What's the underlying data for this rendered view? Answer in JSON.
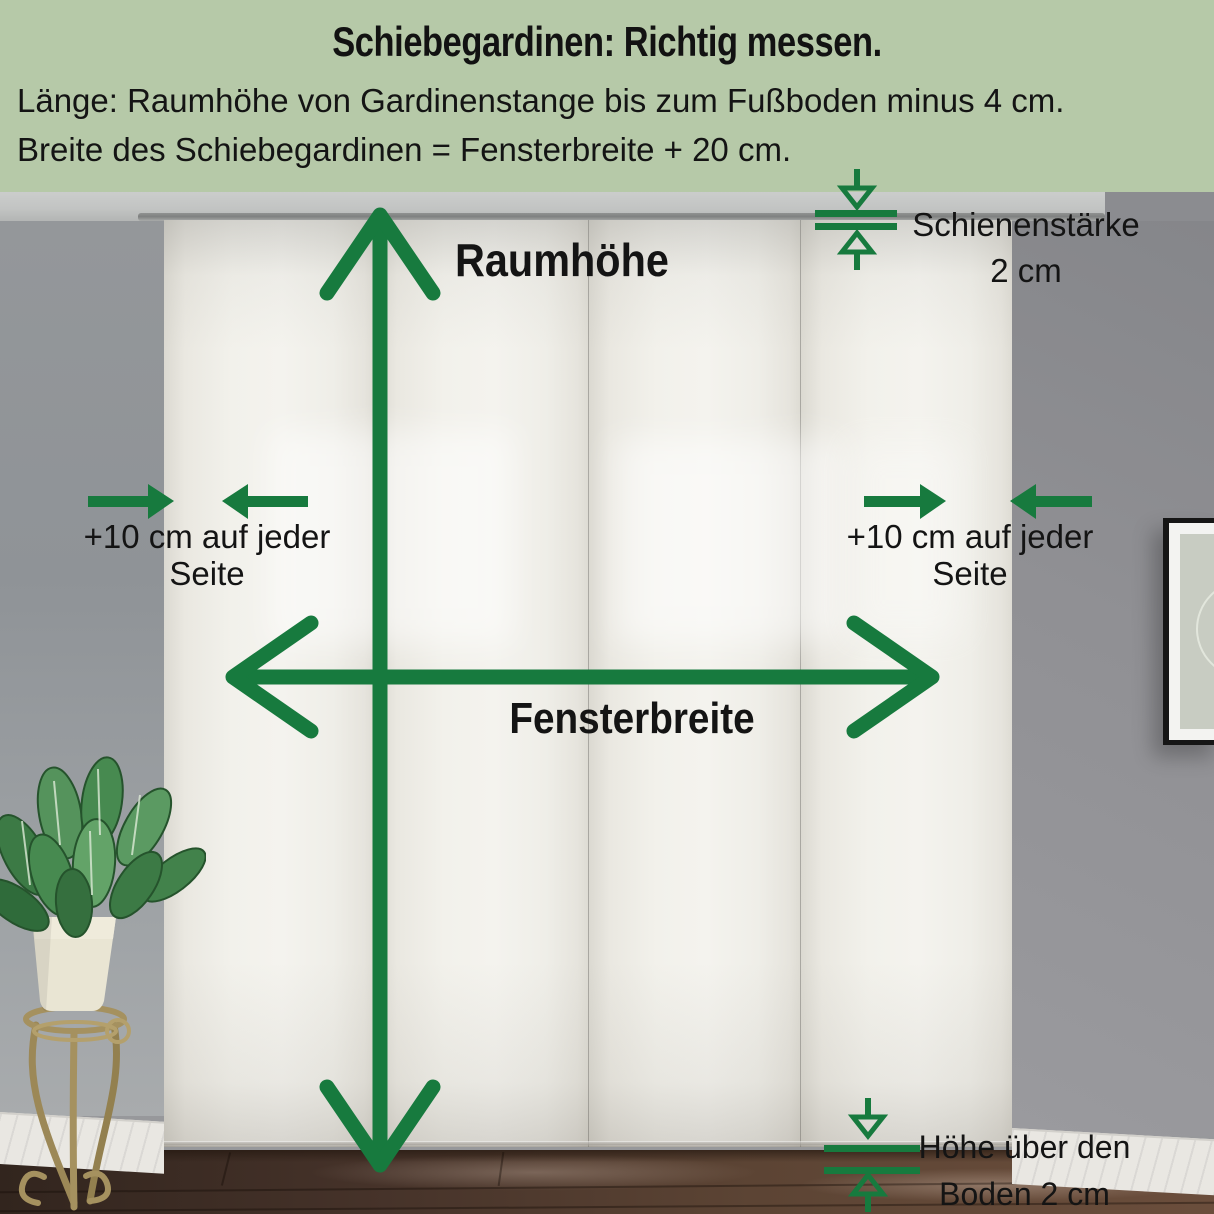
{
  "header": {
    "title": "Schiebegardinen: Richtig messen.",
    "instruction_length": "Länge: Raumhöhe von Gardinenstange bis zum Fußboden minus 4 cm.",
    "instruction_width": "Breite des Schiebegardinen = Fensterbreite + 20 cm."
  },
  "annotations": {
    "room_height_label": "Raumhöhe",
    "window_width_label": "Fensterbreite",
    "left_margin": {
      "line1": "+10 cm auf jeder",
      "line2": "Seite"
    },
    "right_margin": {
      "line1": "+10 cm auf jeder",
      "line2": "Seite"
    },
    "rail_thickness": {
      "line1": "Schienenstärke",
      "line2": "2 cm"
    },
    "floor_clearance": {
      "line1": "Höhe über den",
      "line2": "Boden 2 cm"
    }
  },
  "colors": {
    "arrow_green": "#177a3e",
    "header_background": "#b6c9a8",
    "text": "#141414",
    "curtain_white": "#f2f1ec",
    "wall_gray": "#909094",
    "floor_brown": "#5c4434"
  }
}
